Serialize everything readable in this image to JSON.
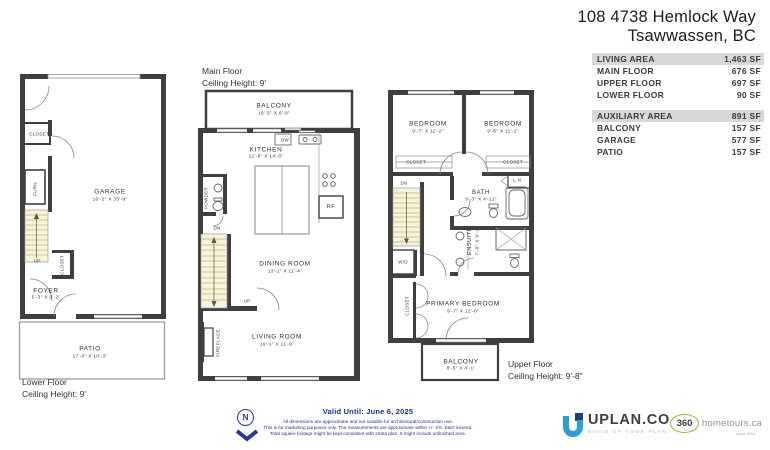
{
  "title": {
    "line1": "108 4738 Hemlock Way",
    "line2": "Tsawwassen, BC"
  },
  "area_tables": {
    "living": {
      "header": {
        "label": "LIVING AREA",
        "value": "1,463 SF"
      },
      "rows": [
        {
          "label": "MAIN FLOOR",
          "value": "676 SF"
        },
        {
          "label": "UPPER FLOOR",
          "value": "697 SF"
        },
        {
          "label": "LOWER FLOOR",
          "value": "90 SF"
        }
      ]
    },
    "auxiliary": {
      "header": {
        "label": "AUXILIARY AREA",
        "value": "891 SF"
      },
      "rows": [
        {
          "label": "BALCONY",
          "value": "157 SF"
        },
        {
          "label": "GARAGE",
          "value": "577 SF"
        },
        {
          "label": "PATIO",
          "value": "157 SF"
        }
      ]
    }
  },
  "floors": {
    "lower": {
      "caption": {
        "line1": "Lower Floor",
        "line2": "Ceiling Height: 9'"
      },
      "labels": {
        "garage": {
          "name": "GARAGE",
          "dims": "16'-2\" X 35'-9\""
        },
        "foyer": {
          "name": "FOYER",
          "dims": "5'-3\" X 9'-2\""
        },
        "patio": {
          "name": "PATIO",
          "dims": "17'-0\" X 10'-3\""
        },
        "closet_top": "CLOSET",
        "closet_side": "CLOSET",
        "furn": "FURN",
        "up": "UP"
      }
    },
    "main": {
      "caption": {
        "line1": "Main Floor",
        "line2": "Ceiling Height: 9'"
      },
      "labels": {
        "balcony": {
          "name": "BALCONY",
          "dims": "16'-5\" X 6'-8\""
        },
        "kitchen": {
          "name": "KITCHEN",
          "dims": "12'-8\" X 14'-8\""
        },
        "dining": {
          "name": "DINING ROOM",
          "dims": "13'-1\" X 11'-4\""
        },
        "living": {
          "name": "LIVING ROOM",
          "dims": "16'-1\" X 11'-9\""
        },
        "powder": "POWDER",
        "fireplace": "FIREPLACE",
        "dw": "DW",
        "rf": "RF",
        "dn": "DN",
        "up": "UP"
      }
    },
    "upper": {
      "caption": {
        "line1": "Upper Floor",
        "line2": "Ceiling Height: 9'-8\""
      },
      "labels": {
        "bedroom1": {
          "name": "BEDROOM",
          "dims": "9'-7\" X 11'-2\""
        },
        "bedroom2": {
          "name": "BEDROOM",
          "dims": "9'-6\" X 11'-2\""
        },
        "bath": {
          "name": "BATH",
          "dims": "9'-3\" X 4'-11\""
        },
        "ensuite": {
          "name": "ENSUITE",
          "dims": "7'-9\" X 9'-2\""
        },
        "primary": {
          "name": "PRIMARY BEDROOM",
          "dims": "9'-7\" X 12'-0\""
        },
        "balcony": {
          "name": "BALCONY",
          "dims": "8'-5\" X 4'-1\""
        },
        "closet1": "CLOSET",
        "closet2": "CLOSET",
        "closet3": "CLOSET",
        "ln": "L.N.",
        "wd": "W/D",
        "dn": "DN"
      }
    }
  },
  "footer": {
    "north_label": "N",
    "valid_until": "Valid Until: June 6, 2025",
    "disclaimer": [
      "All dimensions are approximate and not suitable for architectural/construction use.",
      "This is for marketing purposes only. The measurements are approximate within +/- 2%. E&O insured.",
      "Total square footage might be kept consistent with strata plan. It might include unfinished area."
    ],
    "uplan": {
      "name": "UPLAN.CO",
      "tagline": "BUILD UP YOUR PLAN"
    },
    "hometours": {
      "number": "360",
      "name": "hometours.ca",
      "since": "since 2004"
    }
  },
  "colors": {
    "wall": "#3f3f3f",
    "stairs_fill": "#f8f4dc",
    "window": "#cfd6e4",
    "table_header_bg": "#d8d8d8",
    "footer_navy": "#27348b",
    "uplan_blue": "#2e9fd4",
    "hometours_green": "#96b83d"
  }
}
